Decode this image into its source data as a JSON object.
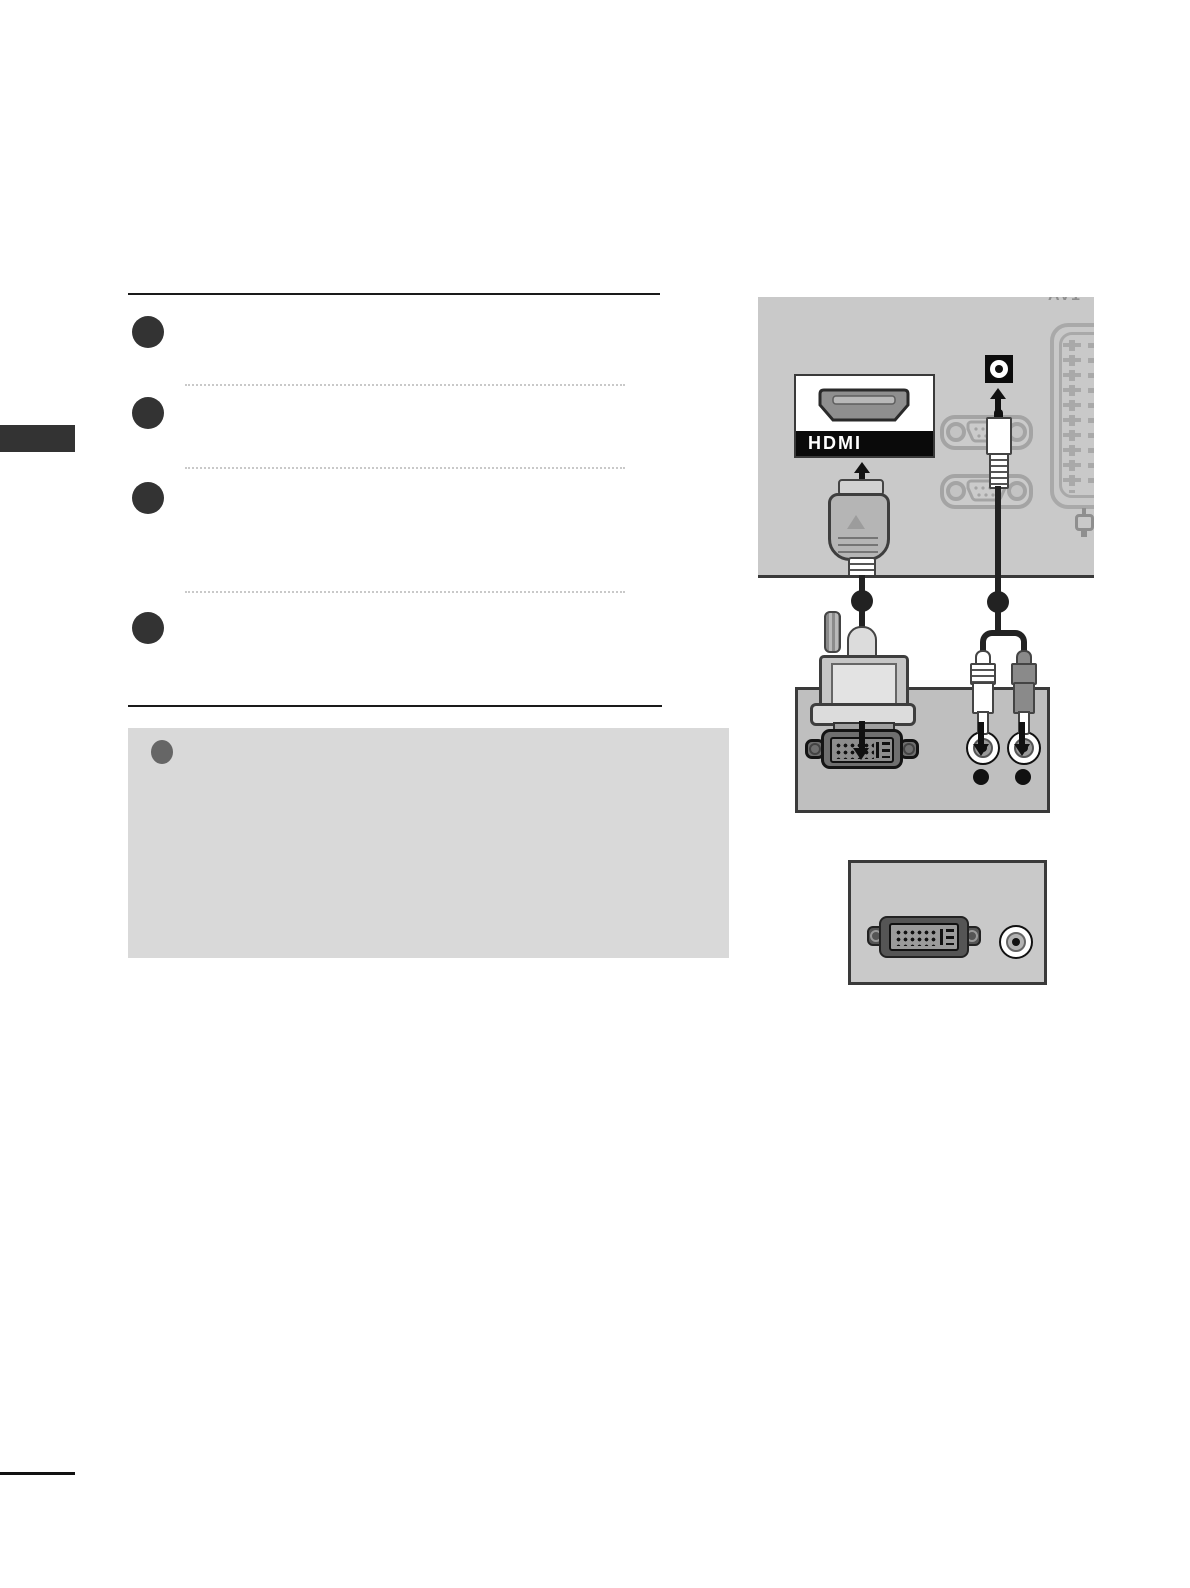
{
  "page": {
    "bg": "#ffffff",
    "kind": "manual-page"
  },
  "sidebar": {
    "tab_color": "#333333"
  },
  "steps": {
    "count": 4,
    "marker_color": "#333333"
  },
  "note_box": {
    "bg": "#d9d9d9",
    "marker_color": "#666666"
  },
  "rear_panel": {
    "label": "AV1",
    "bg": "#c9c9c9",
    "hdmi_logo": "HDMI"
  },
  "device_box": {
    "bg": "#bfbfbf"
  },
  "example_box": {
    "bg": "#c9c9c9"
  },
  "colors": {
    "cable": "#222222",
    "rule": "#1a1a1a",
    "dark_plug": "#8a8a8a"
  },
  "icons": {
    "step_marker": "filled-circle",
    "note_marker": "filled-circle",
    "arrow_up": "triangle-up",
    "arrow_down": "triangle-down",
    "cable_marker": "filled-circle"
  }
}
